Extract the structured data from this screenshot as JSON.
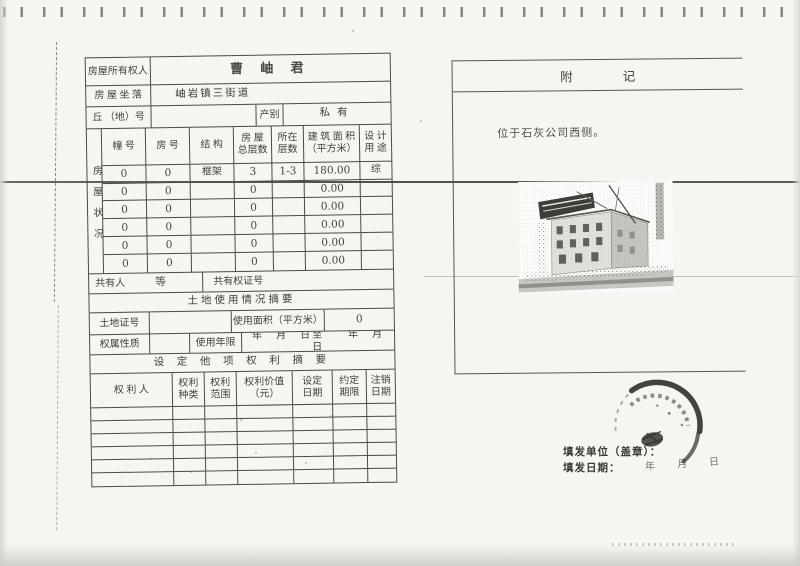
{
  "form": {
    "owner_label": "房屋所有权人",
    "owner_value": "曹 岫 君",
    "location_label": "房 屋 坐 落",
    "location_value": "岫岩镇三街道",
    "plot_label": "丘 （地）号",
    "category_label": "产别",
    "category_value": "私有",
    "housing_side_label": "房屋状况",
    "housing_headers": [
      "幢 号",
      "房 号",
      "结 构",
      "房 屋\n总层数",
      "所在\n层数",
      "建 筑 面 积\n（平方米）",
      "设 计\n用 途"
    ],
    "housing_rows": [
      [
        "0",
        "0",
        "框架",
        "3",
        "1-3",
        "180.00",
        "综"
      ],
      [
        "0",
        "0",
        "",
        "0",
        "",
        "0.00",
        ""
      ],
      [
        "0",
        "0",
        "",
        "0",
        "",
        "0.00",
        ""
      ],
      [
        "0",
        "0",
        "",
        "0",
        "",
        "0.00",
        ""
      ],
      [
        "0",
        "0",
        "",
        "0",
        "",
        "0.00",
        ""
      ],
      [
        "0",
        "0",
        "",
        "0",
        "",
        "0.00",
        ""
      ]
    ],
    "coowner_label": "共有人",
    "coowner_value": "等",
    "coowner_cert_label": "共有权证号",
    "land_section_title": "土地使用情况摘要",
    "land_cert_label": "土地证号",
    "land_area_label": "使用面积（平方米）",
    "land_area_value": "0",
    "land_nature_label": "权属性质",
    "land_term_label": "使用年限",
    "land_term_value": "年　月　日至　　年　月　日",
    "rights_section_title": "设 定 他 项 权 利 摘 要",
    "rights_headers": [
      "权 利 人",
      "权利\n种类",
      "权利\n范围",
      "权利价值\n（元）",
      "设定\n日期",
      "约定\n期限",
      "注销\n日期"
    ]
  },
  "notes": {
    "title": "附　　　　记",
    "content": "位于石灰公司西侧。"
  },
  "footer": {
    "issuer_label": "填发单位（盖章）：",
    "date_label": "填发日期：",
    "date_value": "年　月　日"
  },
  "colors": {
    "ink": "#3d3c38",
    "table_line": "#4b4a45",
    "paper": "#f6f5f2"
  }
}
